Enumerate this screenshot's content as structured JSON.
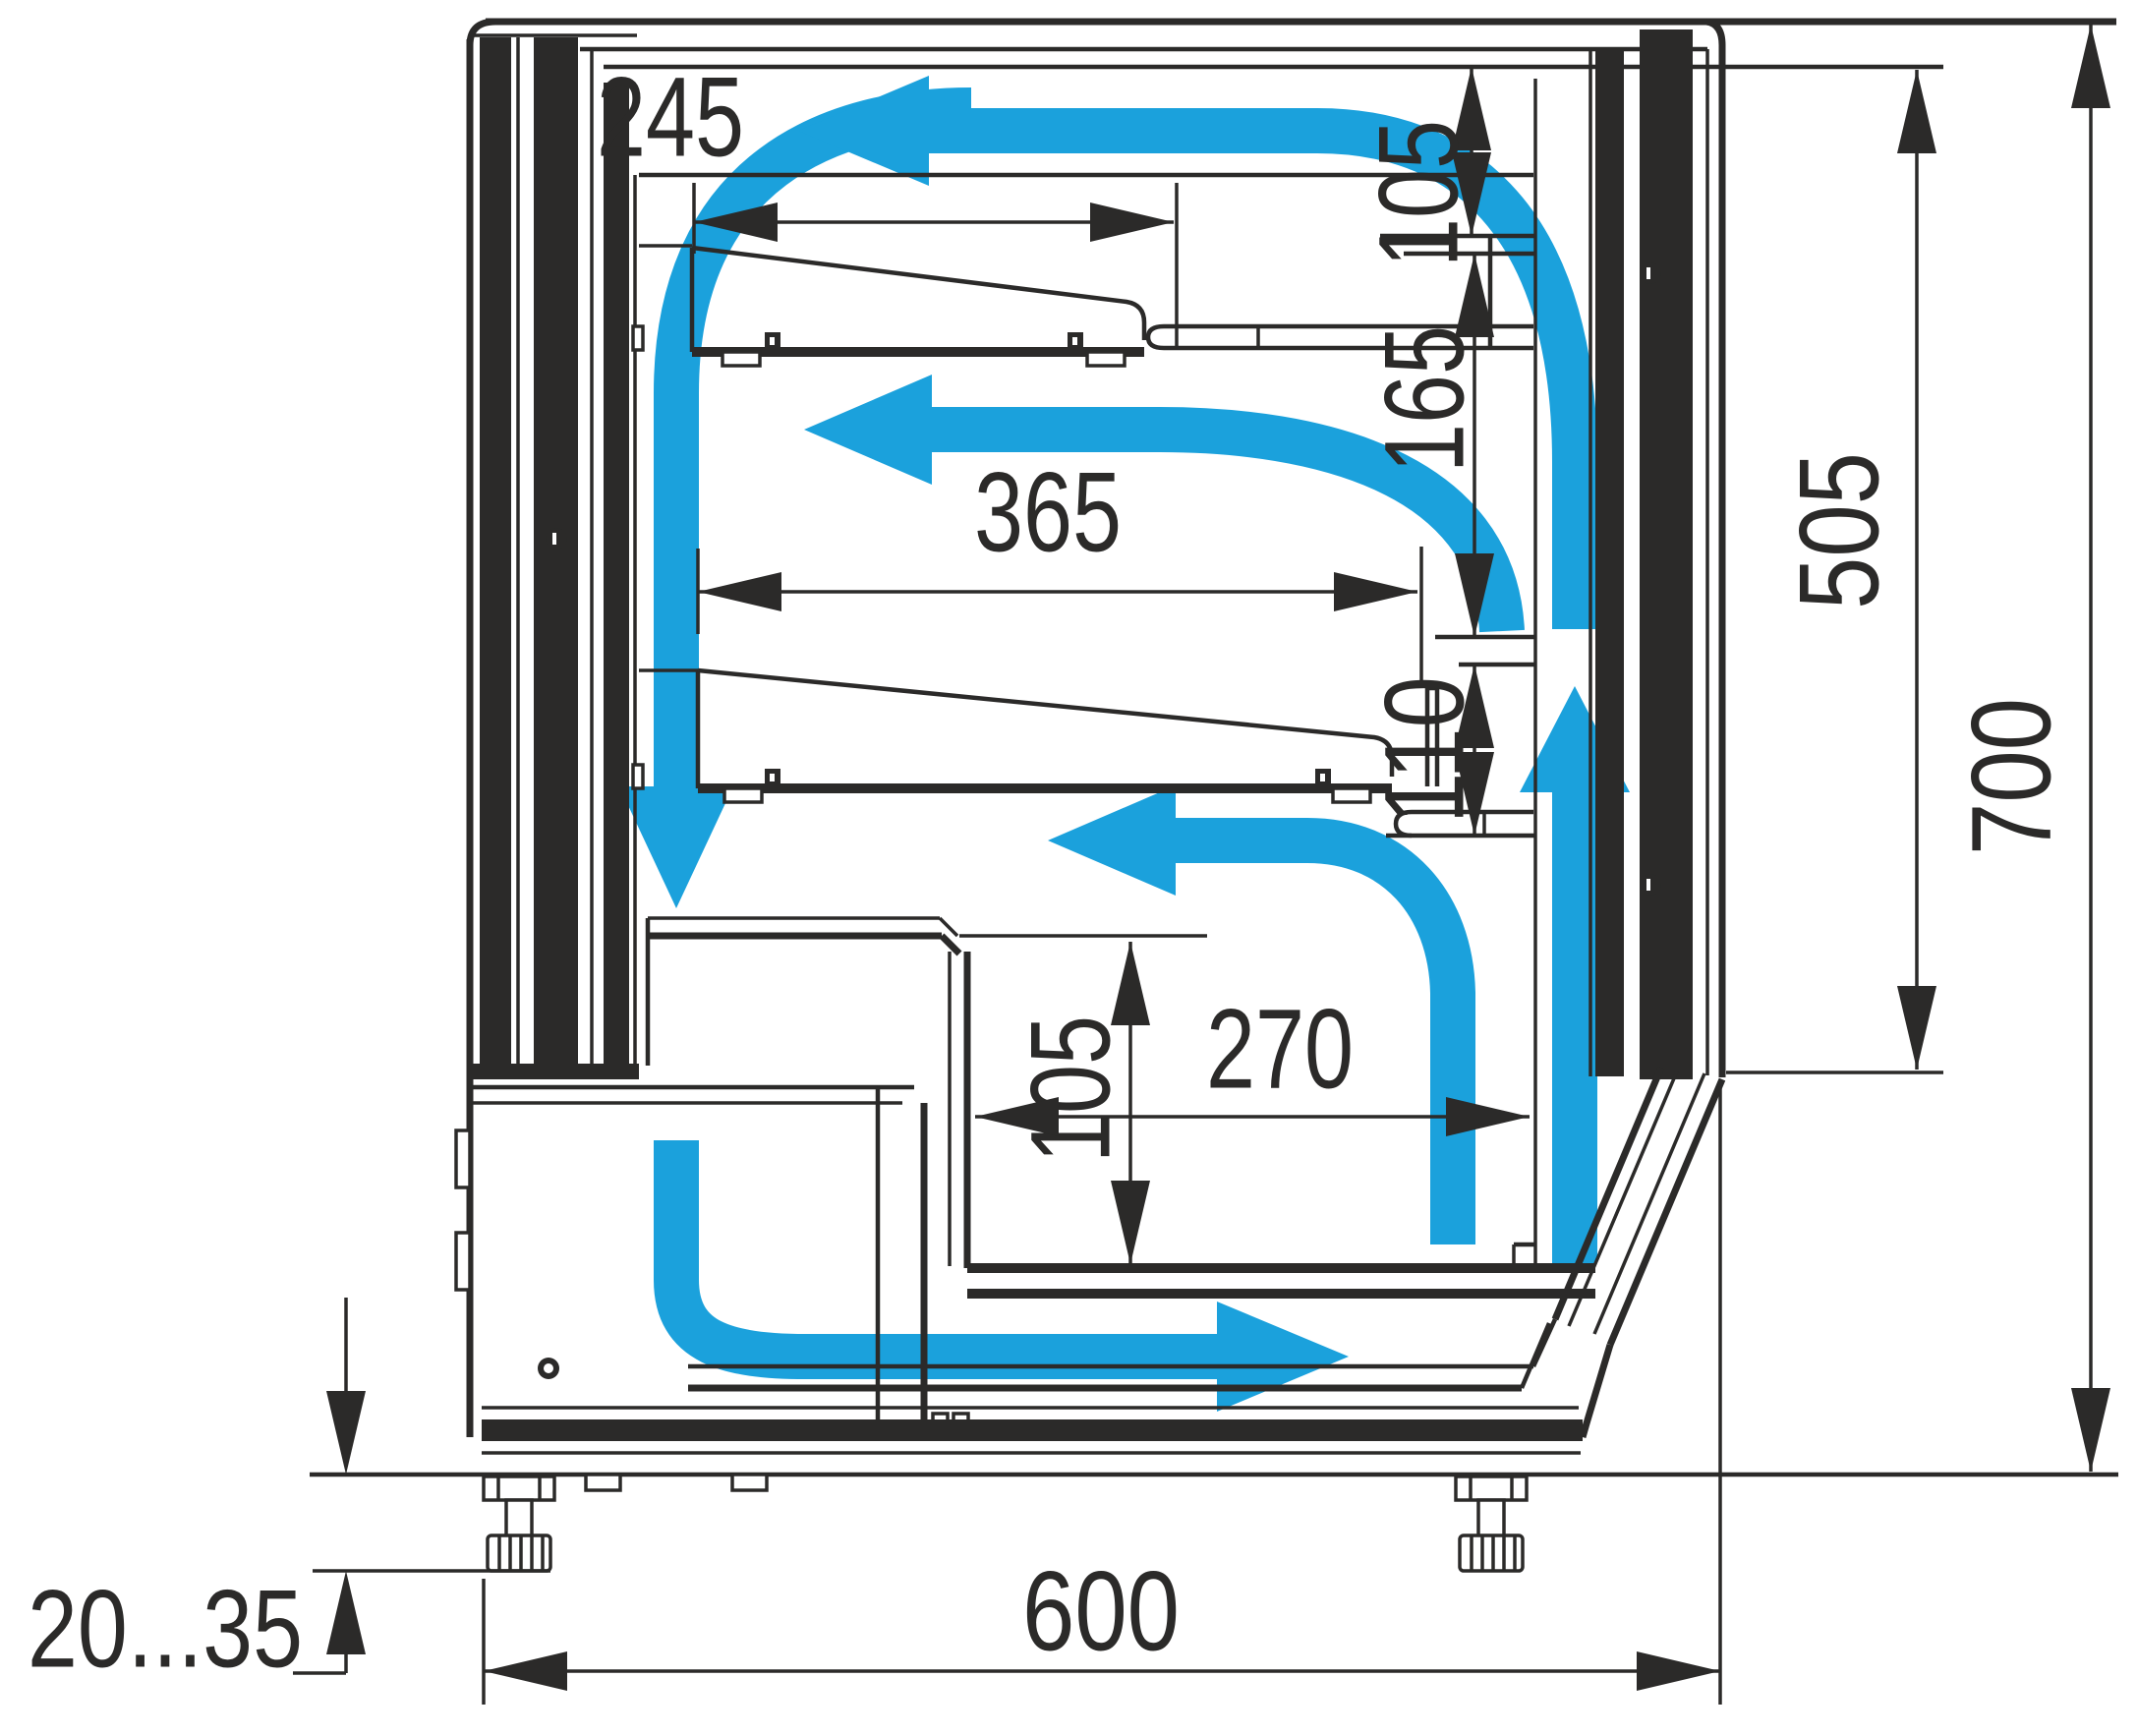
{
  "diagram": {
    "description": "Refrigerated display case cross-section with airflow circulation",
    "colors": {
      "line": "#2b2a29",
      "airflow": "#1ba1dc",
      "background": "#ffffff"
    },
    "dims": {
      "shelf1_width": "245",
      "top_gap": "105",
      "shelf2_width": "365",
      "shelf_gap": "165",
      "well_gap": "110",
      "well_height": "105",
      "well_width": "270",
      "inner_height": "505",
      "overall_height": "700",
      "overall_depth": "600",
      "feet_range": "20...35"
    }
  }
}
